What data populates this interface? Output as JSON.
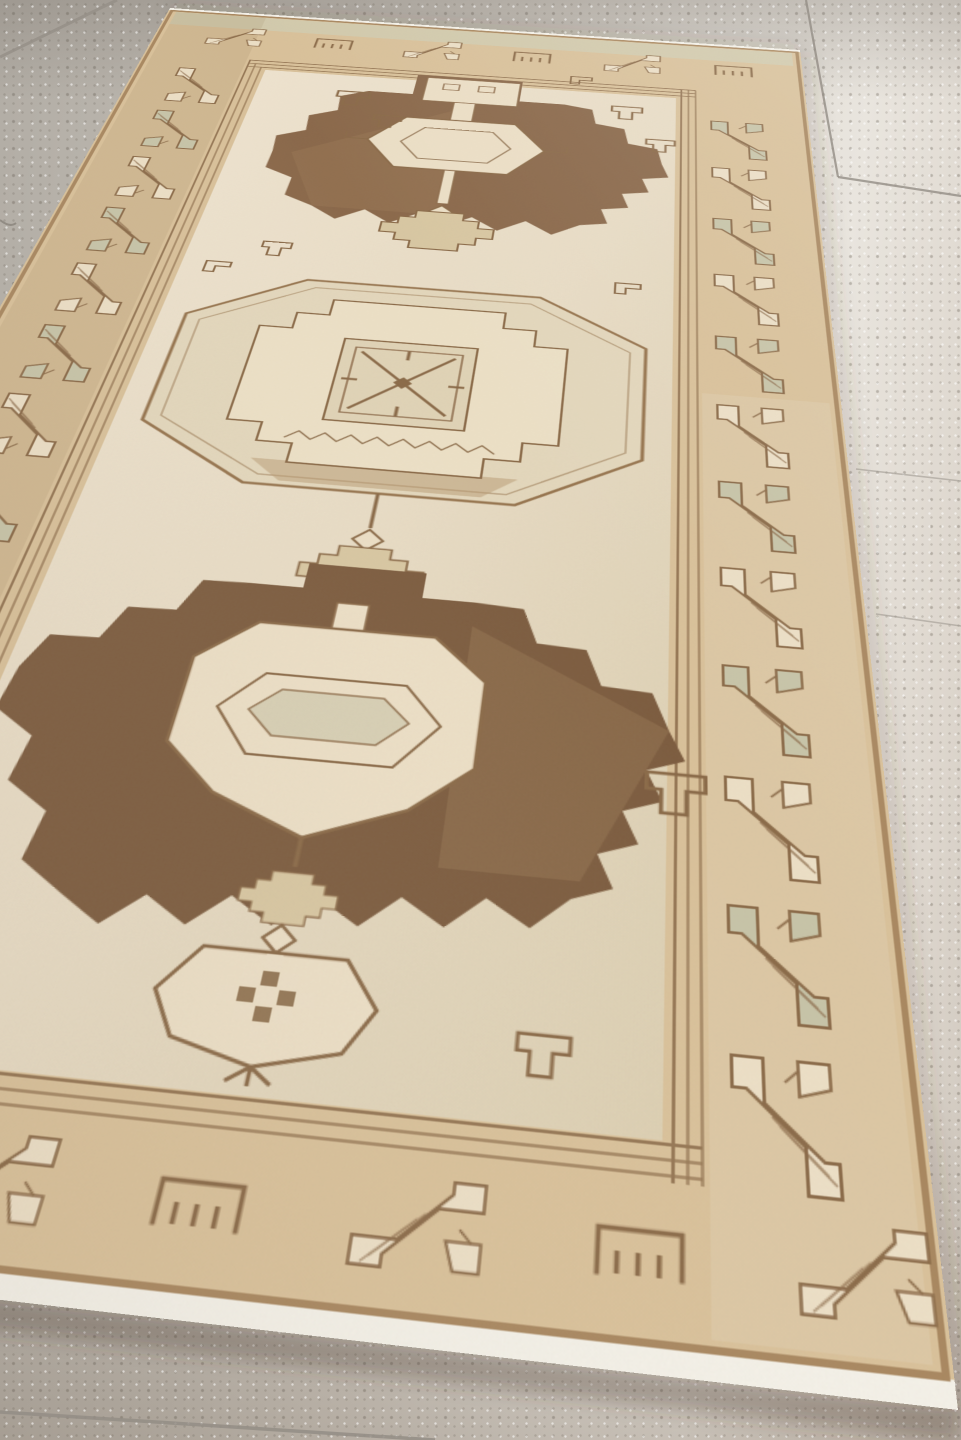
{
  "scene": {
    "type": "photograph",
    "subject": "vintage hand-knotted geometric runner rug on speckled tile floor",
    "style": "Anatolian Oushak runner, washed neutral palette, three-medallion column",
    "medallion_count": 3,
    "lighting": "soft daylight, brighter toward upper right"
  },
  "floor": {
    "tile_gray": "#c2bdb5",
    "tile_light": "#e9e5de",
    "tile_warm": "#b6ada3",
    "grout": "#948e86",
    "grout_lines": [
      [
        0,
        57,
        117,
        0,
        3.0,
        0.75
      ],
      [
        806,
        0,
        838,
        177,
        2.2,
        0.8
      ],
      [
        838,
        177,
        961,
        196,
        2.2,
        0.8
      ],
      [
        856,
        469,
        961,
        481,
        1.6,
        0.5
      ],
      [
        876,
        614,
        961,
        626,
        1.6,
        0.5
      ],
      [
        0,
        1412,
        435,
        1440,
        3.5,
        0.85
      ]
    ]
  },
  "rug": {
    "design_size": [
      760,
      1520
    ],
    "corners": {
      "top_left": [
        170,
        8
      ],
      "top_right": [
        800,
        50
      ],
      "bottom_right": [
        958,
        1410
      ],
      "bottom_left": [
        -530,
        1239
      ]
    },
    "colors": {
      "field": "#e8dcc5",
      "field_deep": "#dccfb2",
      "brown": "#8a684a",
      "brown_dark": "#7c5c3f",
      "brown_light": "#9d7d5a",
      "outline": "#8a6a48",
      "band": "#d9c19a",
      "motif_cream": "#ecdfc6",
      "motif_sage": "#c7c4a8",
      "sage_tint": "#ccd2bc",
      "accent_tan": "#d8c7a2",
      "octagon_fill": "#e3d7bc",
      "octagon_tint": "#d5ceb3",
      "fringe": "#f4f1e8",
      "shadow": "rgba(72,60,48,0.30)"
    }
  }
}
